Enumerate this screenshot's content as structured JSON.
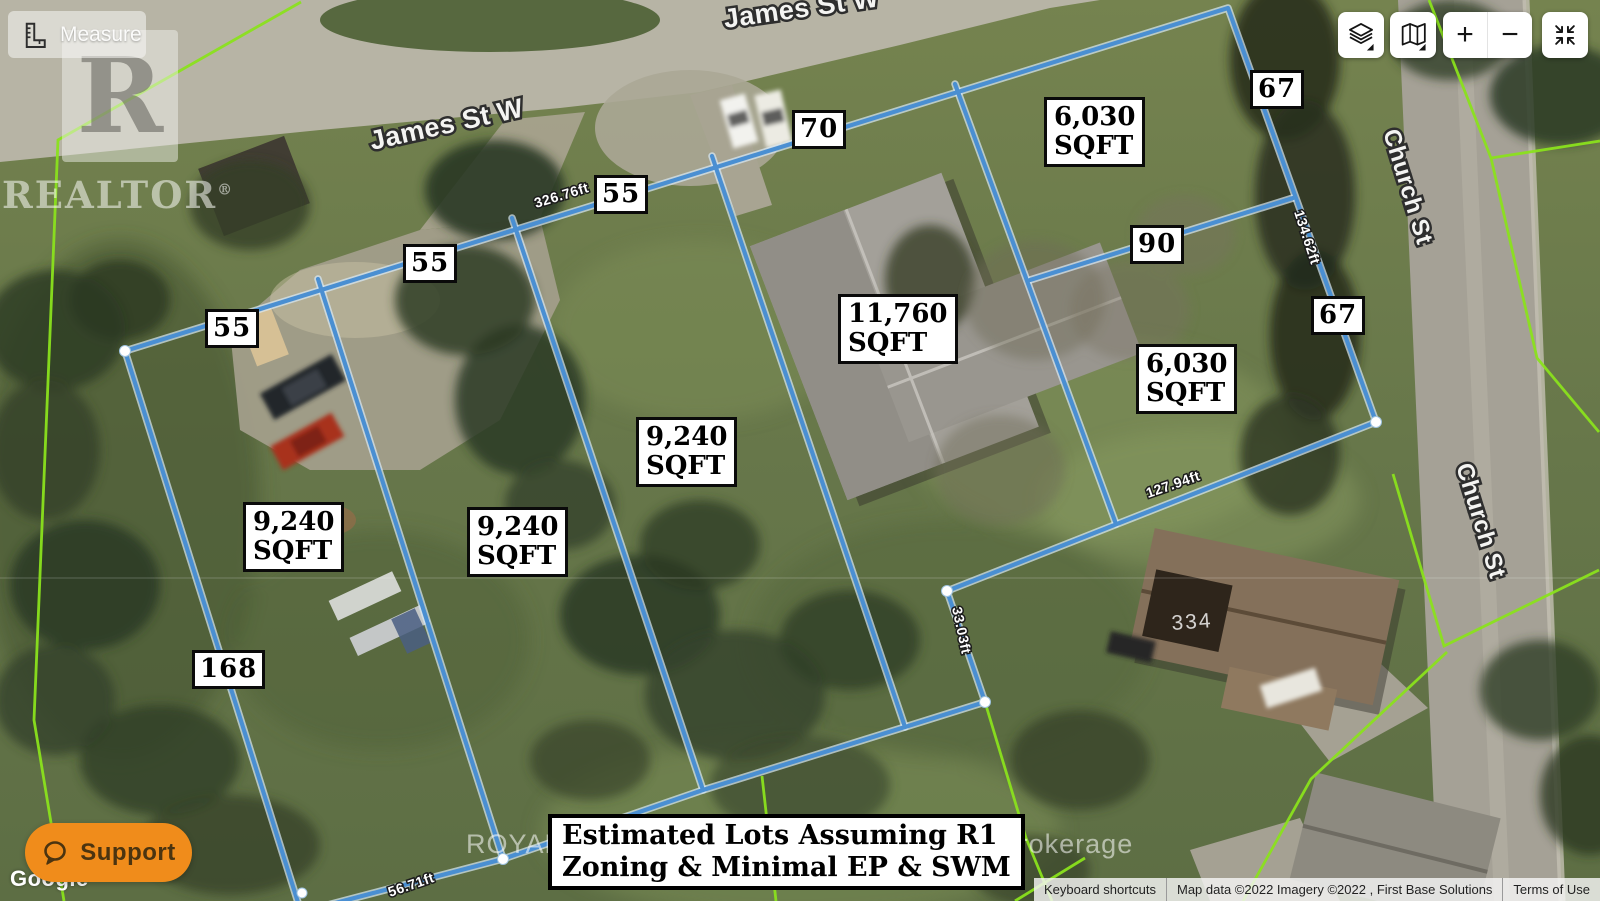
{
  "ui": {
    "measure_button": {
      "label": "Measure",
      "icon": "ruler-icon"
    },
    "map_controls": {
      "layers_button": {
        "icon": "layers-icon"
      },
      "map_type_button": {
        "icon": "folded-map-icon"
      },
      "zoom_in_label": "+",
      "zoom_out_label": "−",
      "collapse_button": {
        "icon": "collapse-arrows-icon"
      }
    },
    "support_button": {
      "label": "Support",
      "icon": "chat-bubble-icon",
      "color": "#f08c1b"
    },
    "google_logo": "Google",
    "attribution": {
      "keyboard_shortcuts": "Keyboard shortcuts",
      "map_data": "Map data ©2022 Imagery ©2022 , First Base Solutions",
      "terms_of_use": "Terms of Use"
    }
  },
  "watermarks": {
    "realtor_letter": "R",
    "realtor": "REALTOR",
    "realtor_reg": "®",
    "brokerage": "ROYAL LEPAGE FRANK REAL ESTATE, Brokerage"
  },
  "annotation": {
    "note_line1": "Estimated Lots Assuming R1",
    "note_line2": "Zoning & Minimal EP & SWM",
    "line_color": "#4a8fd2",
    "lot_areas": [
      {
        "value": "9,240",
        "unit": "SQFT"
      },
      {
        "value": "9,240",
        "unit": "SQFT"
      },
      {
        "value": "9,240",
        "unit": "SQFT"
      },
      {
        "value": "11,760",
        "unit": "SQFT"
      },
      {
        "value": "6,030",
        "unit": "SQFT"
      },
      {
        "value": "6,030",
        "unit": "SQFT"
      }
    ],
    "frontage_labels": [
      "55",
      "55",
      "55",
      "70",
      "67",
      "90",
      "67",
      "168"
    ],
    "segment_measurements": [
      "326.76ft",
      "134.62ft",
      "127.94ft",
      "33.03ft",
      "142",
      "56.71ft"
    ]
  },
  "map_labels": {
    "streets": [
      "James St W",
      "James St W",
      "Church St",
      "Church St"
    ],
    "house_number": "334"
  }
}
